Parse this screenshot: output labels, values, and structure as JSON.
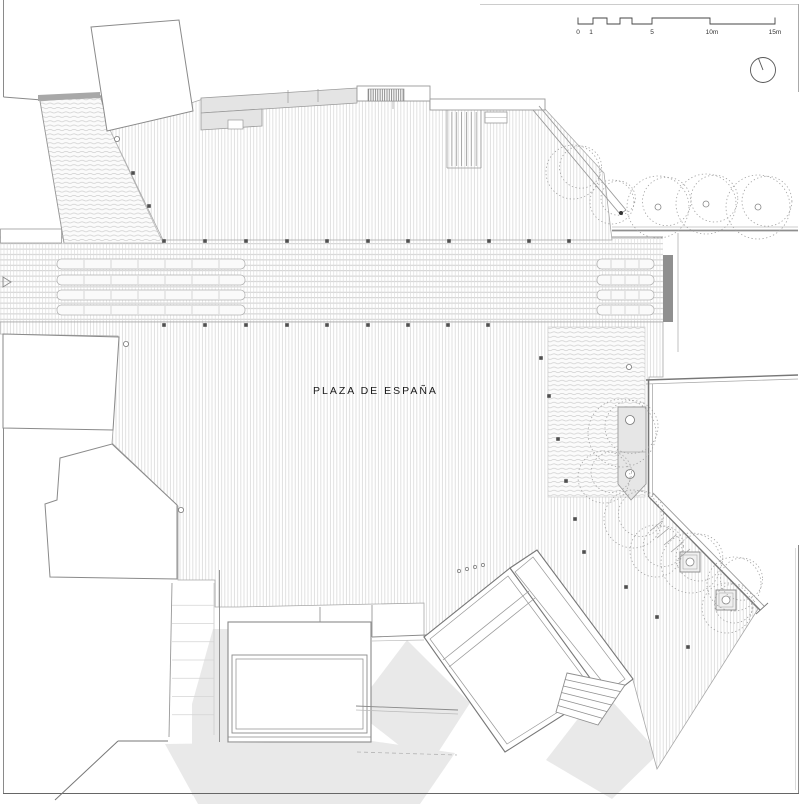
{
  "meta": {
    "plaza_label": "PLAZA DE ESPAÑA"
  },
  "scale_bar": {
    "unit": "m",
    "ticks": [
      {
        "label": "0",
        "x": 578
      },
      {
        "label": "1",
        "x": 591
      },
      {
        "label": "5",
        "x": 652
      },
      {
        "label": "10m",
        "x": 712
      },
      {
        "label": "15m",
        "x": 775
      }
    ],
    "label_y": 34
  },
  "colors": {
    "hatch": "#d9d9d9",
    "road_line": "#c9c9c9",
    "outline": "#999999",
    "dark_line": "#555555",
    "shadow": "#e9e9e9",
    "grey_fill": "#e4e4e4",
    "bar": "#8f8f8f",
    "marker": "#4f4f4f",
    "tree": "#a0a0a0",
    "text": "#1a1a1a"
  },
  "trees": {
    "top_row": [
      {
        "x": 573,
        "y": 172,
        "r": 27
      },
      {
        "x": 612,
        "y": 202,
        "r": 22
      },
      {
        "x": 658,
        "y": 207,
        "r": 31,
        "trunk": true
      },
      {
        "x": 706,
        "y": 204,
        "r": 30,
        "trunk": true
      },
      {
        "x": 758,
        "y": 207,
        "r": 32,
        "trunk": true
      }
    ],
    "right_cluster": [
      {
        "x": 622,
        "y": 433,
        "r": 34
      },
      {
        "x": 604,
        "y": 477,
        "r": 26
      },
      {
        "x": 633,
        "y": 519,
        "r": 29
      },
      {
        "x": 656,
        "y": 551,
        "r": 26
      },
      {
        "x": 691,
        "y": 563,
        "r": 30
      },
      {
        "x": 734,
        "y": 584,
        "r": 27
      },
      {
        "x": 727,
        "y": 608,
        "r": 25
      }
    ]
  },
  "square_planters": [
    {
      "x": 690,
      "y": 562
    },
    {
      "x": 726,
      "y": 600
    }
  ],
  "planter_circles": [
    {
      "x": 630,
      "y": 420
    },
    {
      "x": 630,
      "y": 474
    }
  ],
  "markers": {
    "road_top": {
      "y": 241,
      "xs": [
        164,
        205,
        246,
        287,
        327,
        368,
        408,
        449,
        489,
        529,
        569
      ]
    },
    "road_bottom": {
      "y": 325,
      "xs": [
        164,
        205,
        246,
        287,
        327,
        368,
        408,
        448,
        488
      ]
    },
    "path_lights": [
      {
        "x": 541,
        "y": 358
      },
      {
        "x": 549,
        "y": 396
      },
      {
        "x": 558,
        "y": 439
      },
      {
        "x": 566,
        "y": 481
      },
      {
        "x": 575,
        "y": 519
      },
      {
        "x": 584,
        "y": 552
      },
      {
        "x": 626,
        "y": 587
      },
      {
        "x": 657,
        "y": 617
      },
      {
        "x": 688,
        "y": 647
      }
    ],
    "slope": [
      {
        "x": 133,
        "y": 173
      },
      {
        "x": 149,
        "y": 206
      }
    ],
    "dot": {
      "x": 621,
      "y": 213
    }
  },
  "small_circles": [
    {
      "x": 117,
      "y": 139
    },
    {
      "x": 126,
      "y": 344
    },
    {
      "x": 181,
      "y": 510
    },
    {
      "x": 629,
      "y": 367
    }
  ],
  "dots_row": [
    {
      "x": 459,
      "y": 571
    },
    {
      "x": 467,
      "y": 569
    },
    {
      "x": 475,
      "y": 567
    },
    {
      "x": 483,
      "y": 565
    }
  ],
  "road": {
    "platform_rows_y": [
      259,
      275,
      290,
      305
    ],
    "platform_groups": [
      {
        "x": 57,
        "w": 188,
        "divider_step": 27
      },
      {
        "x": 597,
        "w": 57,
        "divider_step": 14
      }
    ]
  }
}
